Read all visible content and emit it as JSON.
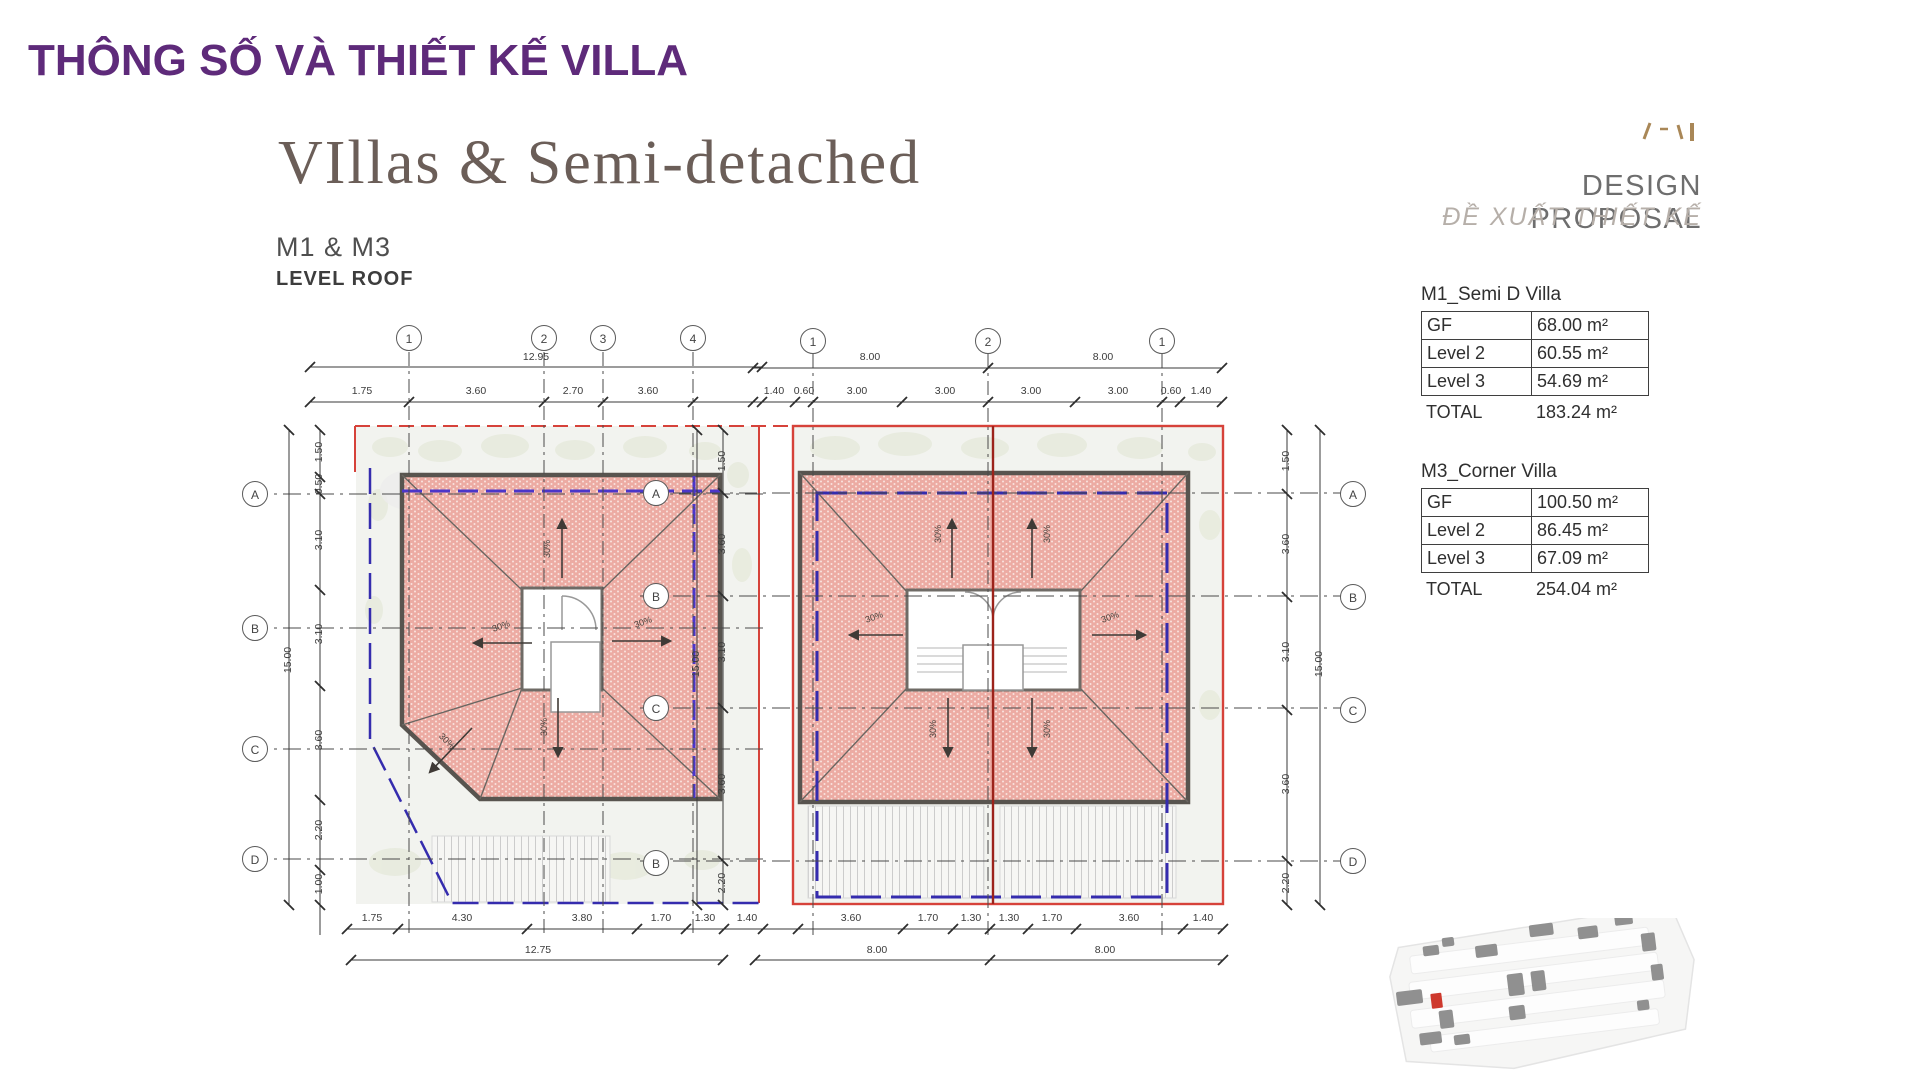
{
  "page": {
    "title": "THÔNG SỐ VÀ THIẾT KẾ VILLA"
  },
  "drawing": {
    "heading": "VIllas & Semi-detached",
    "models_label": "M1 & M3",
    "level_label": "LEVEL ROOF",
    "slope_label": "30%",
    "grid": {
      "plan1_cols": [
        "1",
        "2",
        "3",
        "4"
      ],
      "plan2_cols": [
        "1",
        "2",
        "1"
      ],
      "left_rows": [
        "A",
        "B",
        "C",
        "D"
      ],
      "mid_rows": [
        "A",
        "B",
        "C",
        "B"
      ],
      "right_rows": [
        "A",
        "B",
        "C",
        "D"
      ]
    },
    "dims": {
      "plan1_top_total": "12.95",
      "plan1_top": [
        "1.75",
        "3.60",
        "2.70",
        "3.60"
      ],
      "plan2_top_totals": [
        "8.00",
        "8.00"
      ],
      "plan2_top": [
        "1.40",
        "0.60",
        "3.00",
        "3.00",
        "3.00",
        "3.00",
        "0.60",
        "1.40"
      ],
      "plan1_bottom": [
        "1.75",
        "4.30",
        "3.80",
        "1.70",
        "1.30"
      ],
      "plan1_bottom_total": "12.75",
      "plan2_bottom": [
        "1.40",
        "3.60",
        "1.70",
        "1.30",
        "1.30",
        "1.70",
        "3.60",
        "1.40"
      ],
      "plan2_bottom_totals": [
        "8.00",
        "8.00"
      ],
      "left_side": [
        "1.50",
        "0.50",
        "3.10",
        "3.10",
        "3.60",
        "2.20",
        "1.00"
      ],
      "left_side_total": "15.00",
      "mid_side": [
        "1.50",
        "3.60",
        "3.10",
        "3.60",
        "2.20"
      ],
      "mid_side_total": "15.00",
      "right_side": [
        "1.50",
        "3.60",
        "3.10",
        "3.60",
        "2.20"
      ],
      "right_side_total": "15.00"
    }
  },
  "proposal": {
    "title": "DESIGN PROPOSAL",
    "subtitle": "ĐỀ XUẤT THIẾT KẾ",
    "tables": [
      {
        "name": "M1_Semi D Villa",
        "rows": [
          {
            "label": "GF",
            "value": "68.00 m²"
          },
          {
            "label": "Level 2",
            "value": "60.55 m²"
          },
          {
            "label": "Level 3",
            "value": "54.69 m²"
          }
        ],
        "total_label": "TOTAL",
        "total_value": "183.24 m²"
      },
      {
        "name": "M3_Corner Villa",
        "rows": [
          {
            "label": "GF",
            "value": "100.50 m²"
          },
          {
            "label": "Level 2",
            "value": "86.45 m²"
          },
          {
            "label": "Level 3",
            "value": "67.09 m²"
          }
        ],
        "total_label": "TOTAL",
        "total_value": "254.04 m²"
      }
    ]
  },
  "colors": {
    "accent_purple": "#5e2a7a",
    "boundary_red": "#d6423a",
    "boundary_blue": "#332ba6",
    "roof_fill": "#ecaba3",
    "logo_gold": "#a98757"
  }
}
